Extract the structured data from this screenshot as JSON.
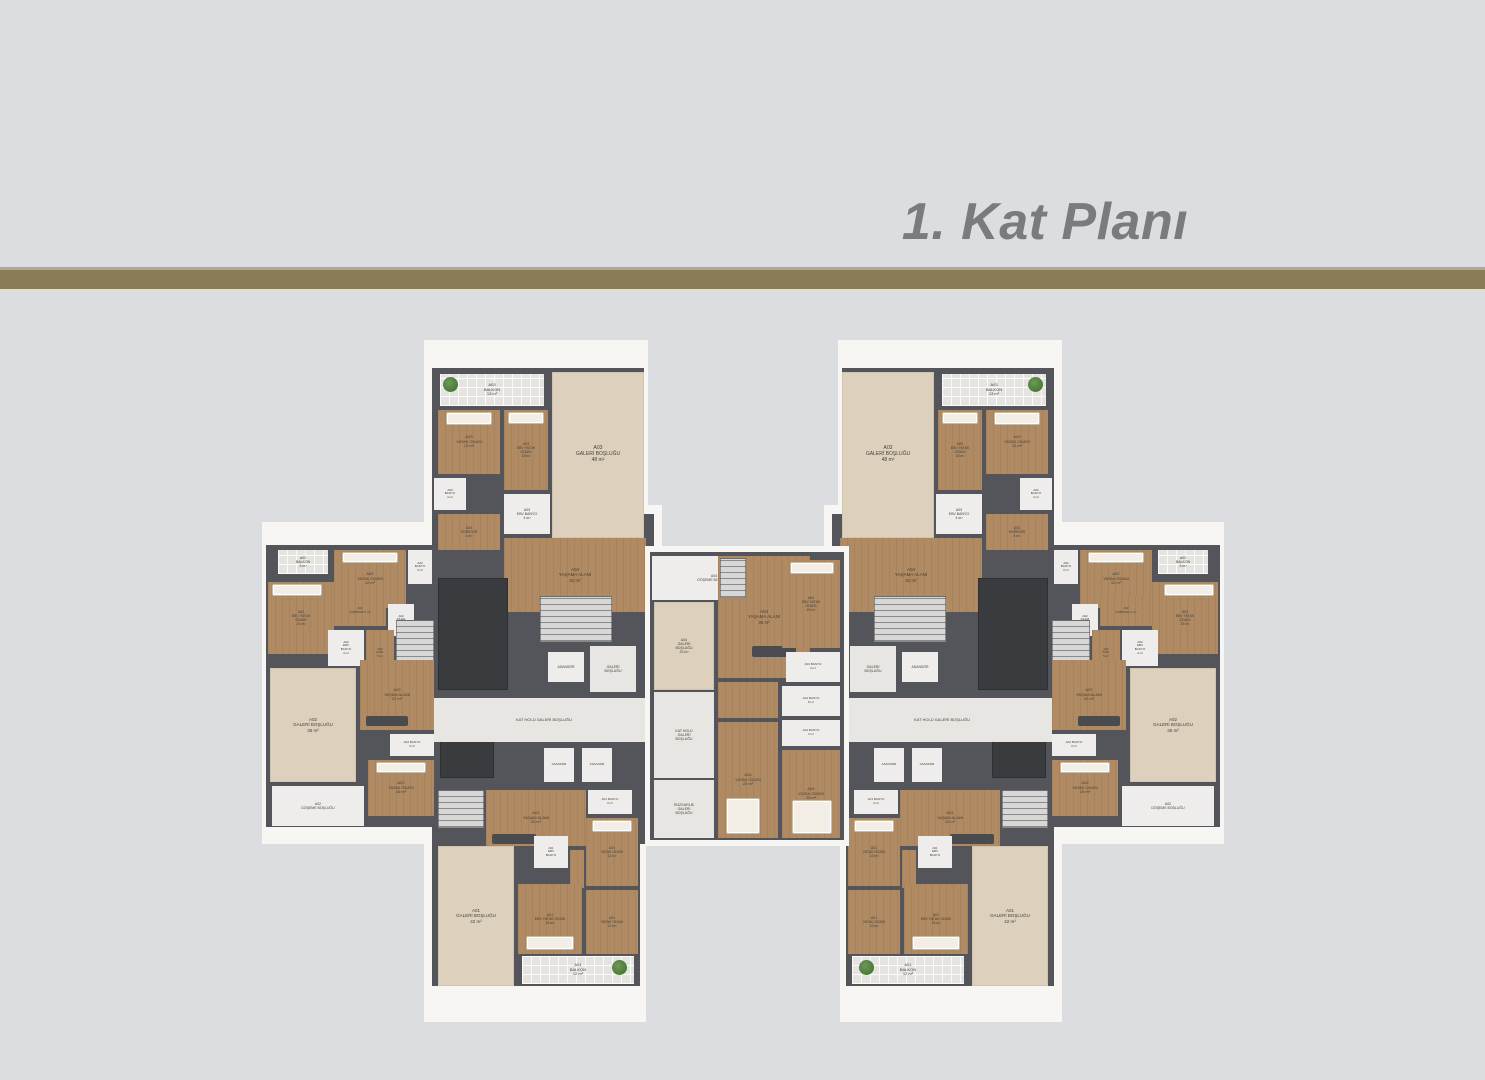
{
  "title": "1. Kat Planı",
  "colors": {
    "bg": "#dcdde0",
    "bar": "#8a7c58",
    "bar_top": "#b6a78a",
    "title": "#7a7b7e",
    "label": "#443f37",
    "paper": "#f8f6f3",
    "wall": "#54555a",
    "wood": "#b08a62",
    "cream": "#ddd1bd",
    "white": "#efedeb",
    "tile": "#e6e4e1",
    "hall": "#e8e6e3",
    "shaft": "#3a3b3f",
    "stairs": "#d8d7d5",
    "bed": "#f3eee6",
    "plant": "#4b7a3d",
    "sofa": "#4a4b4f"
  },
  "plan": {
    "mirror_width": 1486,
    "building": [
      {
        "n": "paper-top-wing",
        "x": 424,
        "y": 340,
        "w": 224,
        "h": 172,
        "f": "paper"
      },
      {
        "n": "paper-core",
        "x": 424,
        "y": 505,
        "w": 238,
        "h": 340,
        "f": "paper"
      },
      {
        "n": "paper-bottom-wing",
        "x": 424,
        "y": 838,
        "w": 222,
        "h": 184,
        "f": "paper"
      },
      {
        "n": "paper-side-wing",
        "x": 262,
        "y": 522,
        "w": 178,
        "h": 322,
        "f": "paper"
      },
      {
        "n": "wall-top-wing",
        "x": 432,
        "y": 368,
        "w": 212,
        "h": 146,
        "f": "wall"
      },
      {
        "n": "wall-core",
        "x": 432,
        "y": 514,
        "w": 222,
        "h": 330,
        "f": "wall"
      },
      {
        "n": "wall-side-wing",
        "x": 266,
        "y": 545,
        "w": 170,
        "h": 282,
        "f": "wall"
      },
      {
        "n": "wall-bottom-wing",
        "x": 432,
        "y": 786,
        "w": 208,
        "h": 200,
        "f": "wall"
      },
      {
        "n": "room-a03-balkon",
        "x": 440,
        "y": 374,
        "w": 104,
        "h": 32,
        "f": "tile",
        "t": "A03\nBALKON\n13 m²",
        "fs": 4
      },
      {
        "n": "plant-icon",
        "x": 443,
        "y": 377,
        "w": 15,
        "h": 15,
        "f": "plant"
      },
      {
        "n": "room-a03-galeri-boslugu",
        "x": 552,
        "y": 372,
        "w": 92,
        "h": 166,
        "f": "cream",
        "t": "A03\nGALERİ BOŞLUĞU\n48 m²",
        "fs": 5
      },
      {
        "n": "room-a03-yatak-odasi",
        "x": 438,
        "y": 410,
        "w": 62,
        "h": 64,
        "f": "wood",
        "t": "A03\nYATAK ODASI\n13 m²",
        "fs": 4
      },
      {
        "n": "bed-icon",
        "x": 446,
        "y": 412,
        "w": 46,
        "h": 13,
        "f": "bed"
      },
      {
        "n": "room-a03-ebv-yatak-odasi",
        "x": 504,
        "y": 410,
        "w": 44,
        "h": 80,
        "f": "wood",
        "t": "A03\nEBV YATAK\nODASI\n15 m²",
        "fs": 3.5
      },
      {
        "n": "bed-icon",
        "x": 508,
        "y": 412,
        "w": 36,
        "h": 12,
        "f": "bed"
      },
      {
        "n": "room-a03-banyo",
        "x": 434,
        "y": 478,
        "w": 32,
        "h": 32,
        "f": "white",
        "t": "A03\nBANYO\n4 m²",
        "fs": 3
      },
      {
        "n": "room-a03-koridor",
        "x": 438,
        "y": 514,
        "w": 62,
        "h": 36,
        "f": "wood",
        "t": "A03\nKORİDOR\n4 m²",
        "fs": 3.5
      },
      {
        "n": "room-a03-ebv-banyo",
        "x": 504,
        "y": 494,
        "w": 46,
        "h": 40,
        "f": "white",
        "t": "A03\nEBV BANYO\n4 m²",
        "fs": 3.5
      },
      {
        "n": "room-a03-yasama-alani",
        "x": 504,
        "y": 538,
        "w": 142,
        "h": 74,
        "f": "wood",
        "t": "A03\nYAŞAMA ALANI\n31 m²",
        "fs": 4.5
      },
      {
        "n": "sofa-icon",
        "x": 560,
        "y": 596,
        "w": 52,
        "h": 12,
        "f": "sofa"
      },
      {
        "n": "stairs",
        "x": 540,
        "y": 596,
        "w": 72,
        "h": 46,
        "f": "stairs"
      },
      {
        "n": "shaft",
        "x": 438,
        "y": 578,
        "w": 70,
        "h": 112,
        "f": "shaft"
      },
      {
        "n": "shaft",
        "x": 440,
        "y": 720,
        "w": 54,
        "h": 58,
        "f": "shaft"
      },
      {
        "n": "elevator-asansor",
        "x": 548,
        "y": 652,
        "w": 36,
        "h": 30,
        "f": "white",
        "t": "ASANSÖR",
        "fs": 3.5
      },
      {
        "n": "room-galeri-boslugu-core",
        "x": 590,
        "y": 646,
        "w": 46,
        "h": 46,
        "f": "hall",
        "t": "GALERİ\nBOŞLUĞU",
        "fs": 3.5
      },
      {
        "n": "room-kat-holu-galeri",
        "x": 434,
        "y": 698,
        "w": 220,
        "h": 44,
        "f": "hall",
        "t": "KAT HOLÜ GALERİ BOŞLUĞU",
        "fs": 4
      },
      {
        "n": "elevator-asansor",
        "x": 544,
        "y": 748,
        "w": 30,
        "h": 34,
        "f": "white",
        "t": "ASANSÖR",
        "fs": 3
      },
      {
        "n": "elevator-asansor",
        "x": 582,
        "y": 748,
        "w": 30,
        "h": 34,
        "f": "white",
        "t": "ASANSÖR",
        "fs": 3
      },
      {
        "n": "room-a02-balkon",
        "x": 278,
        "y": 550,
        "w": 50,
        "h": 24,
        "f": "tile",
        "t": "A02\nBALKON\n5 m²",
        "fs": 3.5
      },
      {
        "n": "room-a02-yatak-odasi",
        "x": 334,
        "y": 550,
        "w": 72,
        "h": 58,
        "f": "wood",
        "t": "A02\nYATAK ODASI\n12 m²",
        "fs": 4
      },
      {
        "n": "bed-icon",
        "x": 342,
        "y": 552,
        "w": 56,
        "h": 11,
        "f": "bed"
      },
      {
        "n": "room-a02-banyo",
        "x": 408,
        "y": 550,
        "w": 24,
        "h": 34,
        "f": "white",
        "t": "A02\nBANYO\n3 m²",
        "fs": 3
      },
      {
        "n": "room-a02-ebv-yatak-odasi",
        "x": 268,
        "y": 582,
        "w": 66,
        "h": 72,
        "f": "wood",
        "t": "A02\nEBV YATAK\nODASI\n15 m²",
        "fs": 3.5
      },
      {
        "n": "bed-icon",
        "x": 272,
        "y": 584,
        "w": 50,
        "h": 12,
        "f": "bed"
      },
      {
        "n": "room-a02-koridor",
        "x": 334,
        "y": 596,
        "w": 52,
        "h": 30,
        "f": "wood",
        "t": "A02\nKORİDOR 4 m²",
        "fs": 3
      },
      {
        "n": "room-a02-kiler",
        "x": 388,
        "y": 604,
        "w": 26,
        "h": 32,
        "f": "white",
        "t": "A02\nKİLER\n2 m²",
        "fs": 3
      },
      {
        "n": "room-a02-ebv-banyo",
        "x": 328,
        "y": 630,
        "w": 36,
        "h": 36,
        "f": "white",
        "t": "A02\nEBV\nBANYO\n4 m²",
        "fs": 3
      },
      {
        "n": "room-a02-koridor-5",
        "x": 366,
        "y": 630,
        "w": 28,
        "h": 46,
        "f": "wood",
        "t": "A02\nKOR.\n5 m²",
        "fs": 3
      },
      {
        "n": "stairs",
        "x": 396,
        "y": 620,
        "w": 38,
        "h": 50,
        "f": "stairs"
      },
      {
        "n": "room-a02-galeri-boslugu",
        "x": 270,
        "y": 668,
        "w": 86,
        "h": 114,
        "f": "cream",
        "t": "A02\nGALERİ BOŞLUĞU\n35 m²",
        "fs": 4.5
      },
      {
        "n": "room-a02-yasam-alani",
        "x": 360,
        "y": 660,
        "w": 74,
        "h": 70,
        "f": "wood",
        "t": "A02\nYAŞAM ALANI\n22 m²",
        "fs": 4
      },
      {
        "n": "sofa-icon",
        "x": 366,
        "y": 716,
        "w": 42,
        "h": 10,
        "f": "sofa"
      },
      {
        "n": "room-a02-banyo-2",
        "x": 390,
        "y": 734,
        "w": 44,
        "h": 22,
        "f": "white",
        "t": "A02 BANYO\n3 m²",
        "fs": 3
      },
      {
        "n": "room-a02-yatak-odasi-2",
        "x": 368,
        "y": 760,
        "w": 66,
        "h": 56,
        "f": "wood",
        "t": "A02\nYATAK ODASI\n16 m²",
        "fs": 4
      },
      {
        "n": "bed-icon",
        "x": 376,
        "y": 762,
        "w": 50,
        "h": 11,
        "f": "bed"
      },
      {
        "n": "room-a02-doseme-boslugu",
        "x": 272,
        "y": 786,
        "w": 92,
        "h": 40,
        "f": "white",
        "t": "A02\nDÖŞEME BOŞLUĞU",
        "fs": 3.5
      },
      {
        "n": "stairs",
        "x": 438,
        "y": 790,
        "w": 46,
        "h": 38,
        "f": "stairs"
      },
      {
        "n": "room-a01-yasam-alani",
        "x": 486,
        "y": 790,
        "w": 100,
        "h": 56,
        "f": "wood",
        "t": "A01\nYAŞAM ALANI\n23 m²",
        "fs": 4
      },
      {
        "n": "sofa-icon",
        "x": 492,
        "y": 834,
        "w": 44,
        "h": 10,
        "f": "sofa"
      },
      {
        "n": "room-a01-banyo",
        "x": 588,
        "y": 790,
        "w": 44,
        "h": 24,
        "f": "white",
        "t": "A01 BANYO\n3 m²",
        "fs": 3
      },
      {
        "n": "room-a01-yatak-odasi",
        "x": 586,
        "y": 818,
        "w": 52,
        "h": 68,
        "f": "wood",
        "t": "A01\nYATAK ODASI\n12 m²",
        "fs": 3.5
      },
      {
        "n": "bed-icon",
        "x": 592,
        "y": 820,
        "w": 40,
        "h": 12,
        "f": "bed"
      },
      {
        "n": "room-a01-ebv-banyo",
        "x": 534,
        "y": 836,
        "w": 34,
        "h": 32,
        "f": "white",
        "t": "A01\nEBV\nBANYO",
        "fs": 3
      },
      {
        "n": "room-a01-koridor",
        "x": 570,
        "y": 850,
        "w": 14,
        "h": 38,
        "f": "wood"
      },
      {
        "n": "room-a01-galeri-boslugu",
        "x": 438,
        "y": 846,
        "w": 76,
        "h": 140,
        "f": "cream",
        "t": "A01\nGALERİ BOŞLUĞU\n42 m²",
        "fs": 4.5
      },
      {
        "n": "room-a01-ebv-yatak-odasi",
        "x": 518,
        "y": 884,
        "w": 64,
        "h": 70,
        "f": "wood",
        "t": "A01\nEBV YATAK ODASI\n15 m²",
        "fs": 3.5
      },
      {
        "n": "bed-icon",
        "x": 526,
        "y": 936,
        "w": 48,
        "h": 14,
        "f": "bed"
      },
      {
        "n": "room-a01-yatak-odasi-2",
        "x": 586,
        "y": 890,
        "w": 52,
        "h": 64,
        "f": "wood",
        "t": "A01\nYATAK ODASI\n12 m²",
        "fs": 3.5
      },
      {
        "n": "room-a01-balkon",
        "x": 522,
        "y": 956,
        "w": 112,
        "h": 28,
        "f": "tile",
        "t": "A01\nBALKON\n12 m²",
        "fs": 4
      },
      {
        "n": "plant-icon",
        "x": 612,
        "y": 960,
        "w": 15,
        "h": 15,
        "f": "plant"
      }
    ],
    "center": [
      {
        "n": "paper-center",
        "x": 645,
        "y": 546,
        "w": 204,
        "h": 300,
        "f": "paper"
      },
      {
        "n": "wall-center",
        "x": 650,
        "y": 552,
        "w": 194,
        "h": 288,
        "f": "wall"
      },
      {
        "n": "room-a04-doseme-boslugu",
        "x": 652,
        "y": 556,
        "w": 124,
        "h": 44,
        "f": "white",
        "t": "A04\nDÖŞEME BOŞLUĞU",
        "fs": 3.5
      },
      {
        "n": "room-a04-galeri-boslugu",
        "x": 654,
        "y": 602,
        "w": 60,
        "h": 88,
        "f": "cream",
        "t": "A04\nGALERİ\nBOŞLUĞU\n23 m²",
        "fs": 3.5
      },
      {
        "n": "room-kat-holu-galeri-center",
        "x": 654,
        "y": 692,
        "w": 60,
        "h": 86,
        "f": "hall",
        "t": "KAT HOLÜ\nGALERİ\nBOŞLUĞU",
        "fs": 3.5
      },
      {
        "n": "room-ruzgarlik-galeri",
        "x": 654,
        "y": 780,
        "w": 60,
        "h": 58,
        "f": "hall",
        "t": "RÜZGARLIK\nGALERİ\nBOŞLUĞU",
        "fs": 3.5
      },
      {
        "n": "room-a04-yasama-alani",
        "x": 718,
        "y": 556,
        "w": 92,
        "h": 122,
        "f": "wood",
        "t": "A04\nYAŞAMA ALANI\n35 m²",
        "fs": 4.5
      },
      {
        "n": "stairs",
        "x": 720,
        "y": 558,
        "w": 26,
        "h": 40,
        "f": "stairs"
      },
      {
        "n": "sofa-icon",
        "x": 752,
        "y": 646,
        "w": 44,
        "h": 11,
        "f": "sofa"
      },
      {
        "n": "room-a04-ebv-yatak-odasi",
        "x": 782,
        "y": 560,
        "w": 58,
        "h": 88,
        "f": "wood",
        "t": "A04\nEBV YATAK\nODASI\n15 m²",
        "fs": 3.5
      },
      {
        "n": "bed-icon",
        "x": 790,
        "y": 562,
        "w": 44,
        "h": 12,
        "f": "bed"
      },
      {
        "n": "room-a04-banyo-4",
        "x": 786,
        "y": 652,
        "w": 54,
        "h": 30,
        "f": "white",
        "t": "A04 BANYO\n4 m²",
        "fs": 3
      },
      {
        "n": "room-a04-banyo-8",
        "x": 782,
        "y": 686,
        "w": 58,
        "h": 30,
        "f": "white",
        "t": "A04 BANYO\n8 m²",
        "fs": 3
      },
      {
        "n": "room-a04-banyo-3",
        "x": 782,
        "y": 720,
        "w": 58,
        "h": 26,
        "f": "white",
        "t": "A04 BANYO\n3 m²",
        "fs": 3
      },
      {
        "n": "room-a04-koridor",
        "x": 718,
        "y": 682,
        "w": 60,
        "h": 36,
        "f": "wood"
      },
      {
        "n": "room-a04-yatak-odasi-22",
        "x": 718,
        "y": 722,
        "w": 60,
        "h": 116,
        "f": "wood",
        "t": "A04\nYATAK ODASI\n22 m²",
        "fs": 4
      },
      {
        "n": "bed-icon",
        "x": 726,
        "y": 798,
        "w": 34,
        "h": 36,
        "f": "bed"
      },
      {
        "n": "room-a04-yatak-odasi-20",
        "x": 782,
        "y": 750,
        "w": 58,
        "h": 88,
        "f": "wood",
        "t": "A04\nYATAK ODASI\n20 m²",
        "fs": 4
      },
      {
        "n": "bed-icon",
        "x": 792,
        "y": 800,
        "w": 40,
        "h": 34,
        "f": "bed"
      }
    ]
  }
}
